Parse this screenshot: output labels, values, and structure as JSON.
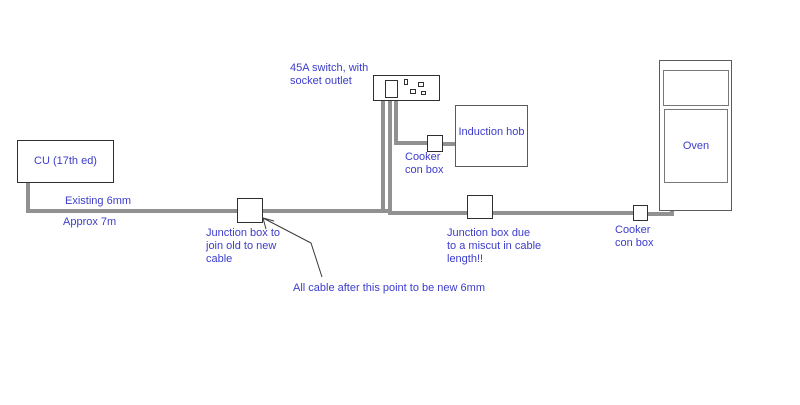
{
  "canvas": {
    "width": 800,
    "height": 405,
    "background": "#ffffff"
  },
  "colors": {
    "label_text": "#3c3ccc",
    "wire": "#919191",
    "box_border": "#2f2f2f",
    "appliance_border": "#5a5a5a",
    "oven_inner_border": "#777777",
    "arrow": "#3a3a3a"
  },
  "labels": {
    "cu": "CU (17th ed)",
    "existing_cable": "Existing 6mm",
    "approx_length": "Approx 7m",
    "switch": "45A switch, with\nsocket outlet",
    "cooker_con_box_1": "Cooker\ncon box",
    "induction_hob": "Induction hob",
    "junction_box_1": "Junction box to\njoin old to new\ncable",
    "junction_box_2": "Junction box due\nto a miscut in cable\nlength!!",
    "all_cable_note": "All cable after this point to be new 6mm",
    "cooker_con_box_2": "Cooker\ncon box",
    "oven": "Oven"
  }
}
